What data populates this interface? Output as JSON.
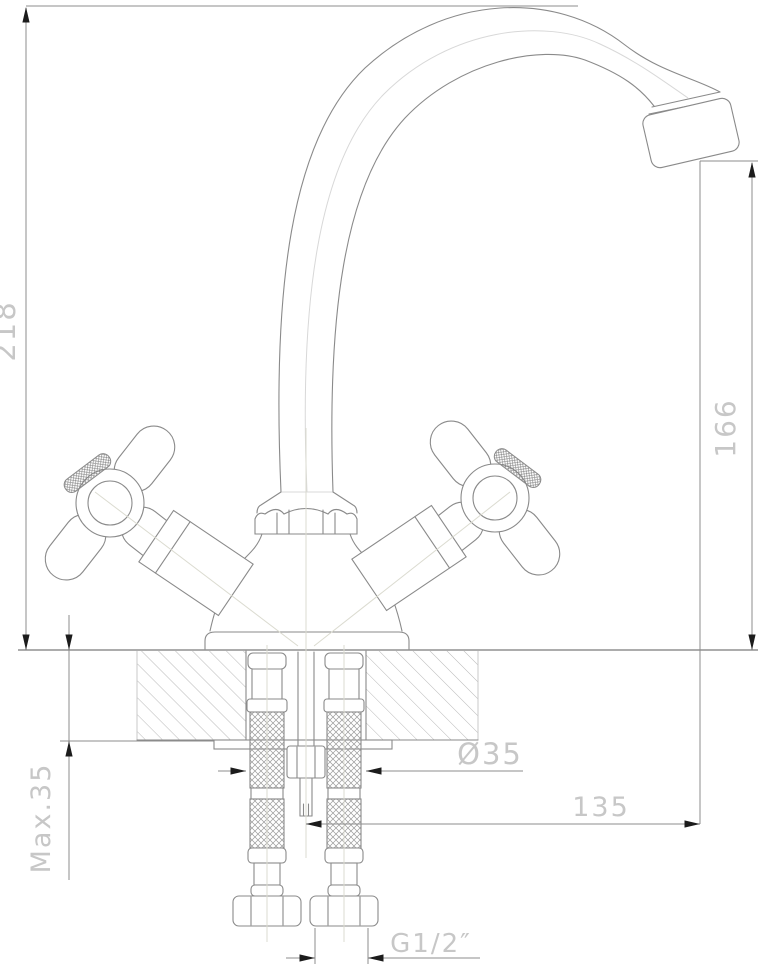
{
  "drawing": {
    "kind": "faucet installation technical drawing",
    "dimensions": {
      "height_total": "218",
      "height_spout": "166",
      "deck_thickness": "Max.35",
      "hole_diameter": "Ø35",
      "spout_reach": "135",
      "connection_thread": "G1/2″"
    },
    "colors": {
      "background": "#ffffff",
      "outline": "#8a8a8a",
      "dimension_line": "#8c8c8c",
      "dimension_text": "#c7c7c7",
      "arrowhead": "#1c1c1c",
      "centerline": "#dbdbd0",
      "hatch": "#b9b9b9"
    }
  }
}
